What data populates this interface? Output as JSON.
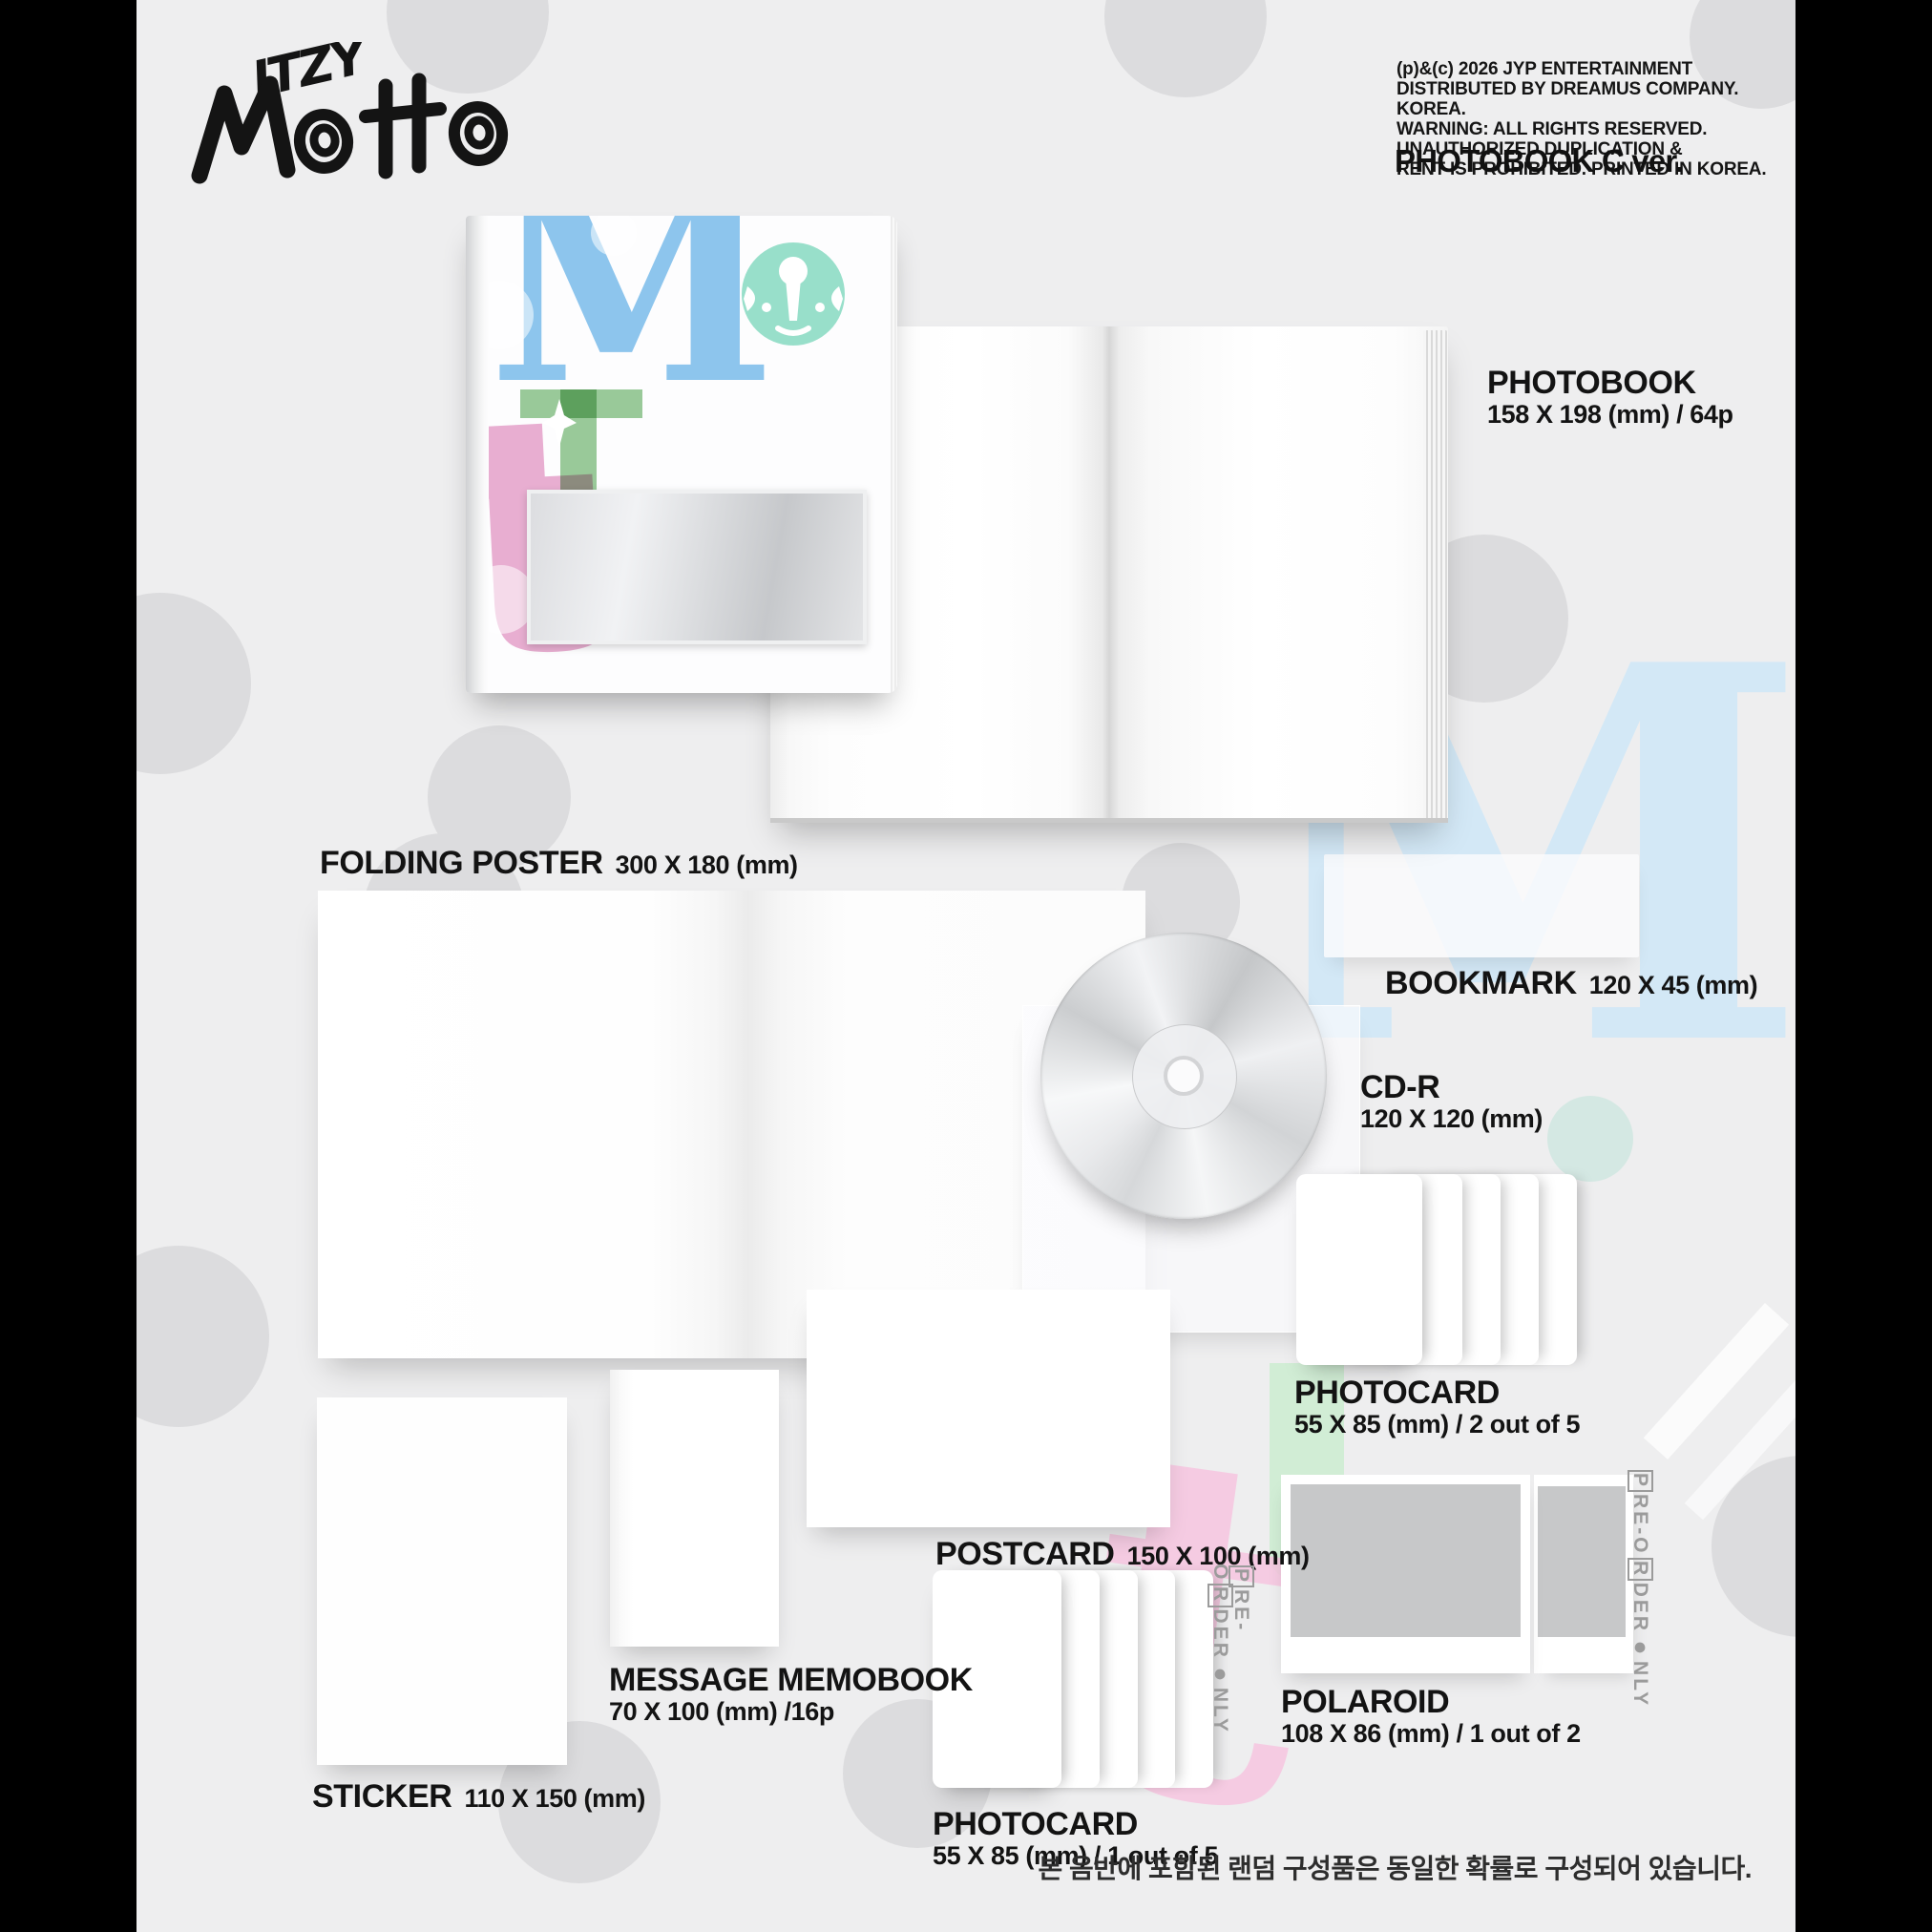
{
  "brand": {
    "artist": "ITZY",
    "album": "MOTTO"
  },
  "header": {
    "copyright_lines": [
      "(p)&(c) 2026 JYP ENTERTAINMENT",
      "DISTRIBUTED BY DREAMUS COMPANY. KOREA.",
      "WARNING: ALL RIGHTS RESERVED.",
      "UNAUTHORIZED DUPLICATION &",
      "RENT IS PROHIBITED. PRINTED IN KOREA."
    ],
    "version": "PHOTOBOOK C ver."
  },
  "components": {
    "photobook": {
      "title": "PHOTOBOOK",
      "dims": "158 X 198 (mm) / 64p"
    },
    "folding_poster": {
      "title": "FOLDING POSTER",
      "dims": "300 X 180 (mm)"
    },
    "bookmark": {
      "title": "BOOKMARK",
      "dims": "120 X 45 (mm)"
    },
    "cdr": {
      "title": "CD-R",
      "dims": "120 X 120 (mm)"
    },
    "photocard_a": {
      "title": "PHOTOCARD",
      "dims": "55 X 85 (mm) / 2 out of 5"
    },
    "postcard": {
      "title": "POSTCARD",
      "dims": "150 X 100 (mm)"
    },
    "memobook": {
      "title": "MESSAGE MEMOBOOK",
      "dims": "70 X 100 (mm) /16p"
    },
    "sticker": {
      "title": "STICKER",
      "dims": "110 X 150 (mm)"
    },
    "photocard_b": {
      "title": "PHOTOCARD",
      "dims": "55 X 85 (mm) / 1 out of 5"
    },
    "polaroid": {
      "title": "POLAROID",
      "dims": "108 X 86 (mm) / 1 out of 2"
    }
  },
  "preorder": {
    "label": "PRE-ORDER ONLY",
    "seg_p": "P",
    "seg_re": "RE-O",
    "seg_r": "R",
    "seg_der": "DER",
    "seg_dot": "●",
    "seg_nly": "NLY"
  },
  "cover_art": {
    "letter_m": "M",
    "letter_t": "t",
    "swirl": "G"
  },
  "footnote_kr": "본 음반에 포함된 랜덤 구성품은 동일한 확률로 구성되어 있습니다.",
  "colors": {
    "background": "#eeeeef",
    "frame": "#000000",
    "dot": "#dcdcde",
    "cover_blue": "#8ec7ee",
    "cover_teal": "#8fdcc6",
    "cover_green": "#9acb9a",
    "cover_pink": "#eab0d2",
    "faint_blue": "#cfe8f8",
    "faint_green": "#c9ecce",
    "faint_pink": "#f7c6e0",
    "silver": "#d4d6d8",
    "label_text": "#131313",
    "preorder_gray": "#9b9b9b"
  }
}
